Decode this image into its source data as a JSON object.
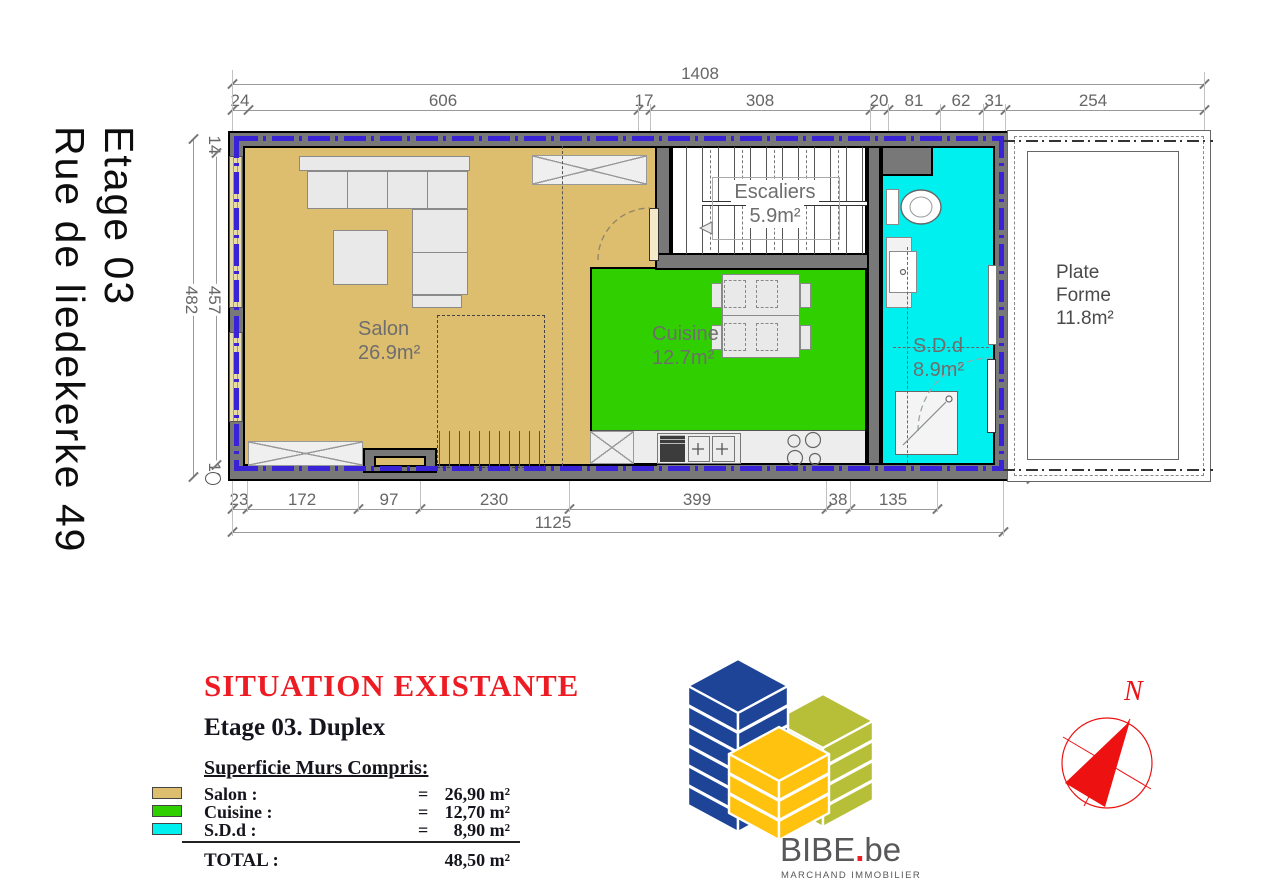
{
  "page": {
    "floor_label": "Etage 03",
    "address": "Rue de liedekerke 49"
  },
  "plan": {
    "rooms": {
      "salon": {
        "label": "Salon",
        "area": "26.9m²",
        "color": "#DDBD6E"
      },
      "cuisine": {
        "label": "Cuisine",
        "area": "12.7m²",
        "color": "#30CF00"
      },
      "sdd": {
        "label": "S.D.d",
        "area": "8.9m²",
        "color": "#00EFEF"
      },
      "escaliers": {
        "label": "Escaliers",
        "area": "5.9m²"
      },
      "plate_forme": {
        "lines": [
          "Plate",
          "Forme",
          "11.8m²"
        ]
      }
    },
    "dims": {
      "top_total": "1408",
      "top": [
        "24",
        "606",
        "17",
        "308",
        "20",
        "81",
        "62",
        "31",
        "254"
      ],
      "left": [
        "14",
        "482",
        "457",
        "10"
      ],
      "bottom": [
        "23",
        "172",
        "97",
        "230",
        "399",
        "38",
        "135"
      ],
      "bottom_total": "1125",
      "right": [
        "14",
        "451",
        "18"
      ]
    }
  },
  "legend": {
    "title": "SITUATION EXISTANTE",
    "subtitle": "Etage 03. Duplex",
    "section_title": "Superficie Murs Compris:",
    "rows": [
      {
        "label": "Salon :",
        "eq": "=",
        "value": "26,90 m²"
      },
      {
        "label": "Cuisine :",
        "eq": "=",
        "value": "12,70 m²"
      },
      {
        "label": "S.D.d :",
        "eq": "=",
        "value": "8,90 m²"
      }
    ],
    "total_label": "TOTAL :",
    "total_value": "48,50 m²"
  },
  "logo": {
    "wordmark": "BIBE",
    "dot": ".",
    "tld": "be",
    "tagline": "MARCHAND IMMOBILIER"
  },
  "compass": {
    "north_label": "N"
  },
  "colors": {
    "wall": "#787878",
    "upper_floor_dashed_line": "#3A23D6",
    "dimension_text": "#666666",
    "legend_red": "#ED1C24",
    "logo_blue": "#1D4496",
    "logo_olive": "#B7BE38",
    "logo_yellow": "#FFC20E",
    "compass_red": "#ED1111"
  }
}
